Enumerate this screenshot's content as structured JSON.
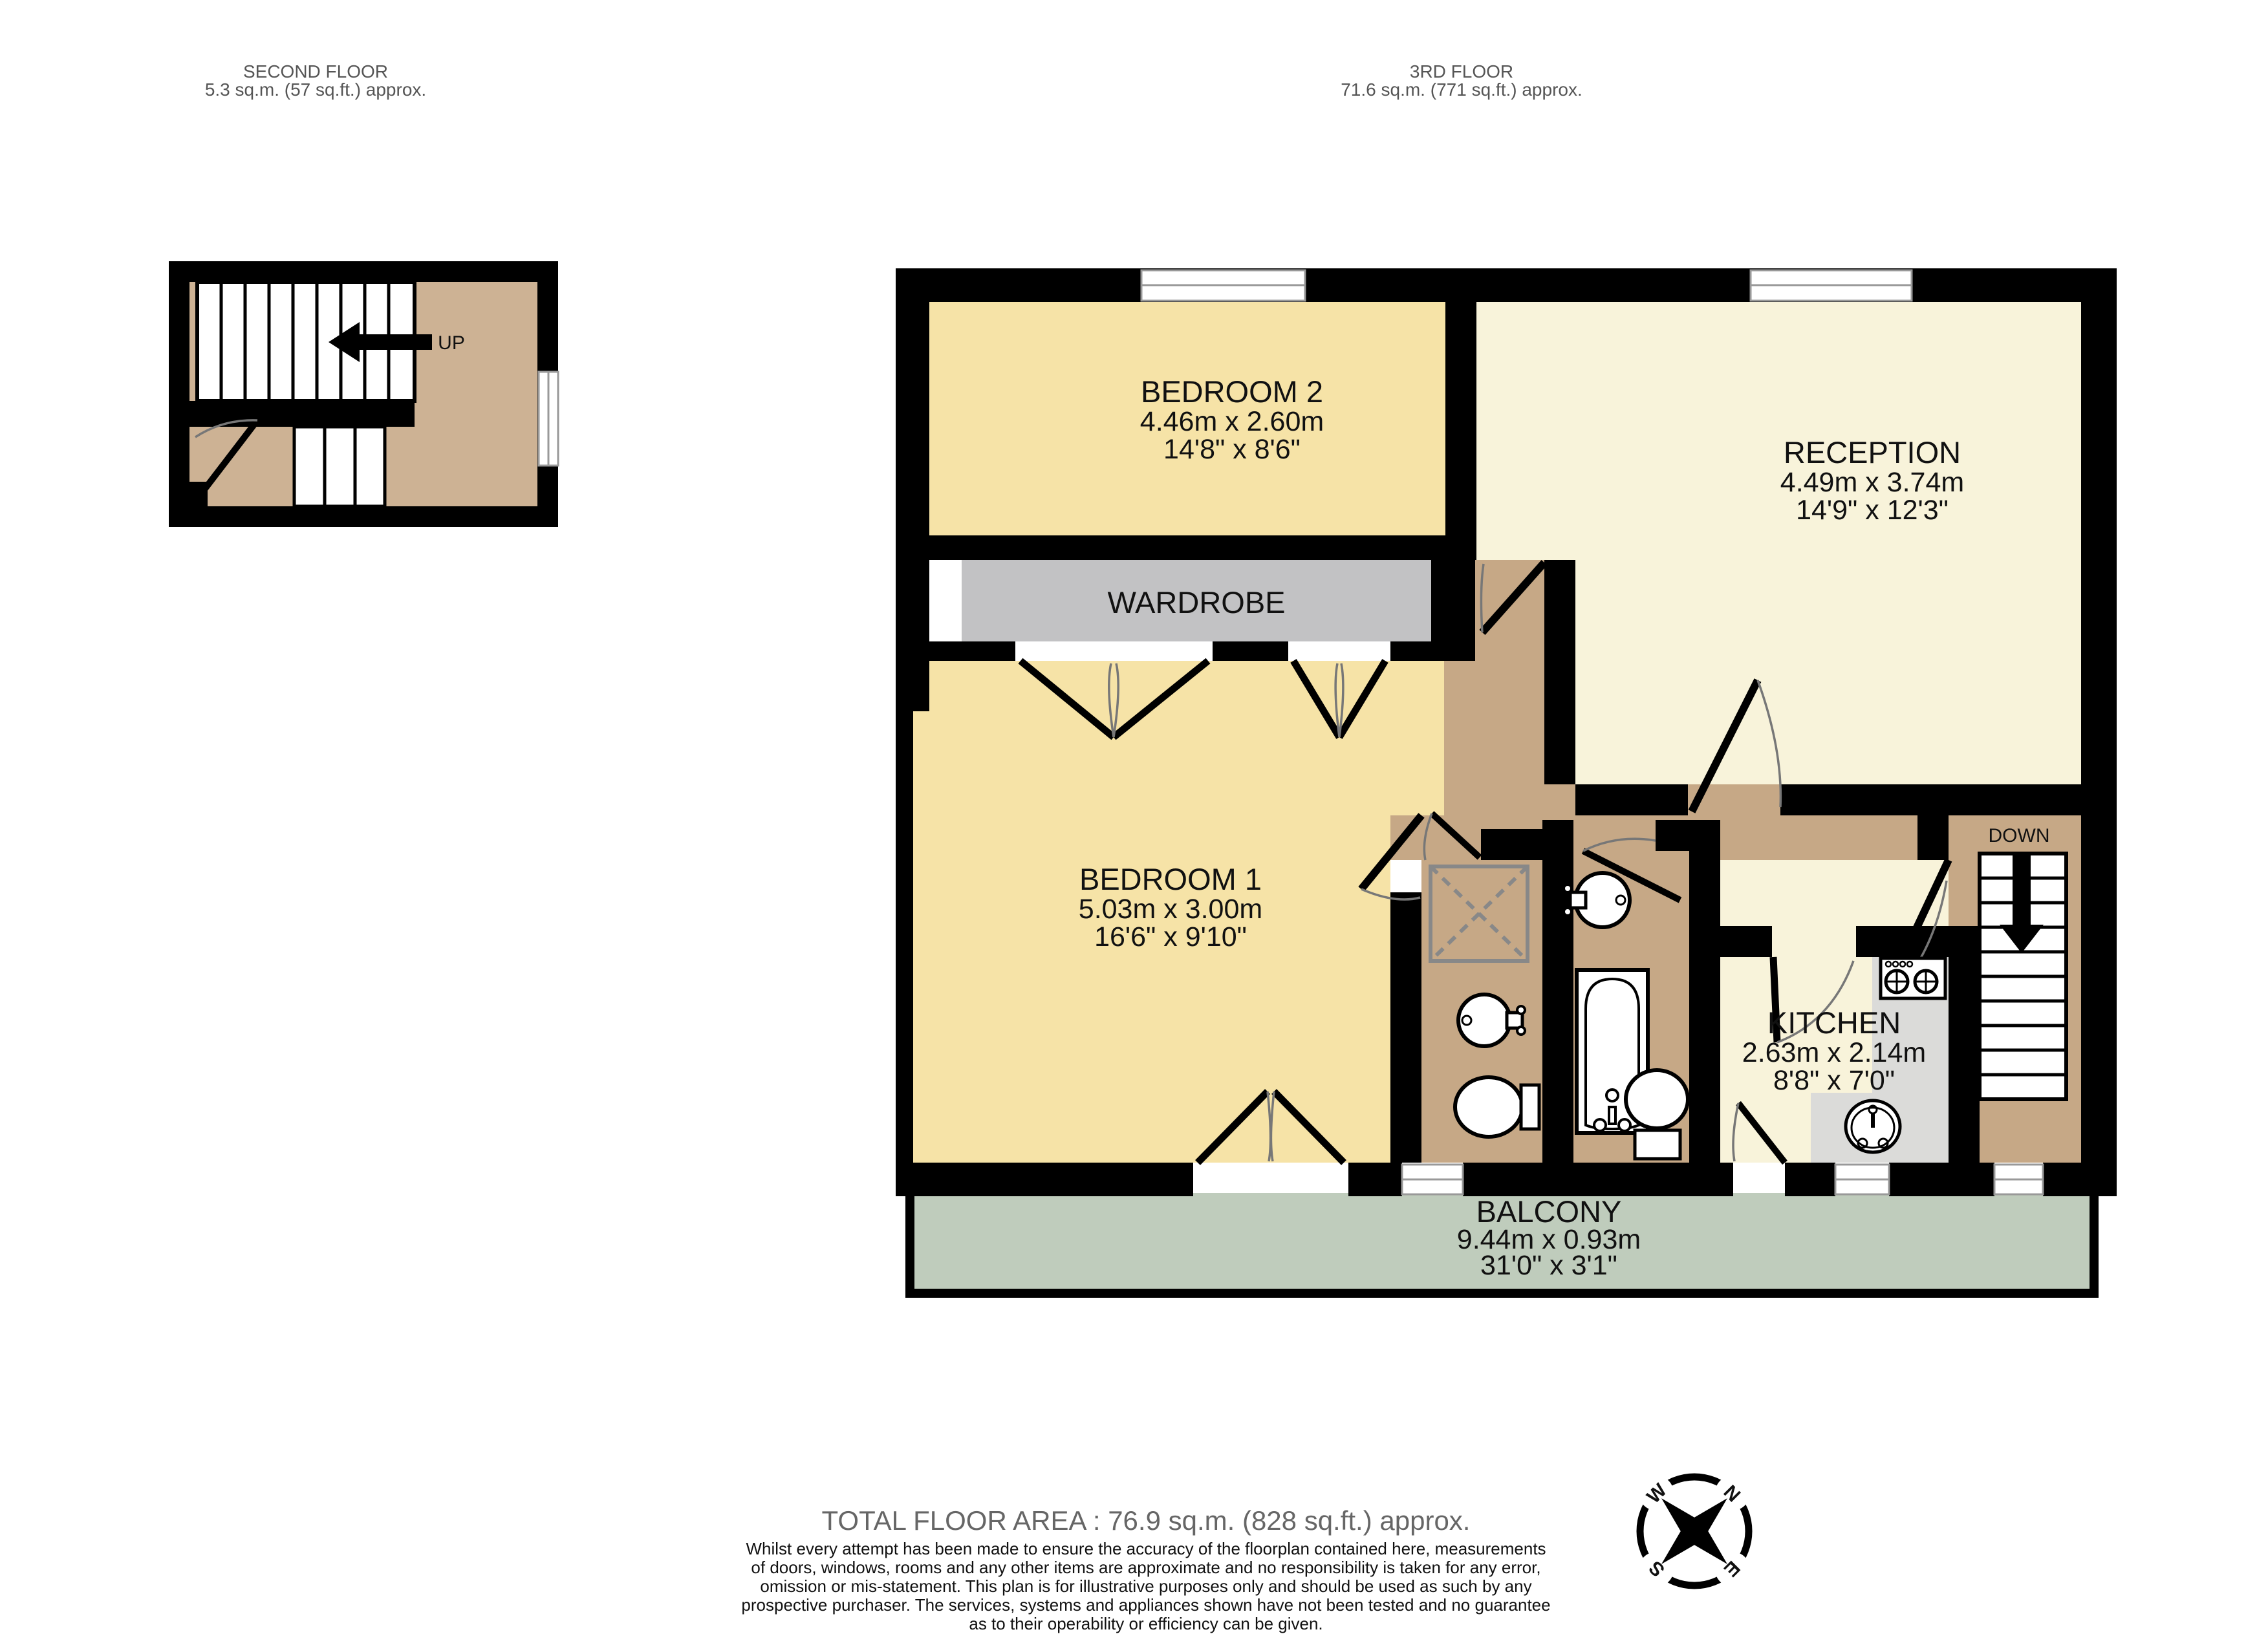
{
  "floors": {
    "second": {
      "title": "SECOND FLOOR",
      "area": "5.3 sq.m. (57 sq.ft.) approx.",
      "stair_label": "UP"
    },
    "third": {
      "title": "3RD FLOOR",
      "area": "71.6 sq.m. (771 sq.ft.) approx.",
      "stair_label": "DOWN"
    }
  },
  "rooms": {
    "bedroom2": {
      "name": "BEDROOM 2",
      "metric": "4.46m  x 2.60m",
      "imperial": "14'8\"  x 8'6\""
    },
    "reception": {
      "name": "RECEPTION",
      "metric": "4.49m  x 3.74m",
      "imperial": "14'9\"  x 12'3\""
    },
    "bedroom1": {
      "name": "BEDROOM 1",
      "metric": "5.03m  x 3.00m",
      "imperial": "16'6\"  x 9'10\""
    },
    "kitchen": {
      "name": "KITCHEN",
      "metric": "2.63m  x 2.14m",
      "imperial": "8'8\"  x 7'0\""
    },
    "balcony": {
      "name": "BALCONY",
      "metric": "9.44m  x 0.93m",
      "imperial": "31'0\"  x 3'1\""
    },
    "wardrobe": {
      "name": "WARDROBE"
    }
  },
  "compass": {
    "n": "N",
    "e": "E",
    "s": "S",
    "w": "W"
  },
  "footer": {
    "total": "TOTAL FLOOR AREA : 76.9 sq.m. (828 sq.ft.) approx.",
    "lines": [
      "Whilst every attempt has been made to ensure the accuracy of the floorplan contained here, measurements",
      "of doors, windows, rooms and any other items are approximate and no responsibility is taken for any error,",
      "omission or mis-statement. This plan is for illustrative purposes only and should be used as such by any",
      "prospective purchaser. The services, systems and appliances shown have not been tested and no guarantee",
      "as to their operability or efficiency can be given."
    ],
    "credit": "Made with Metropix ©2023"
  },
  "colors": {
    "wall": "#000000",
    "bedroom_fill": "#F6E3A7",
    "reception_fill": "#F8F3DA",
    "hall_fill": "#C6A886",
    "landing_fill": "#CDB294",
    "balcony_fill": "#BFCCBC",
    "wardrobe_fill": "#C2C2C4",
    "counter_fill": "#DBDBD9"
  }
}
